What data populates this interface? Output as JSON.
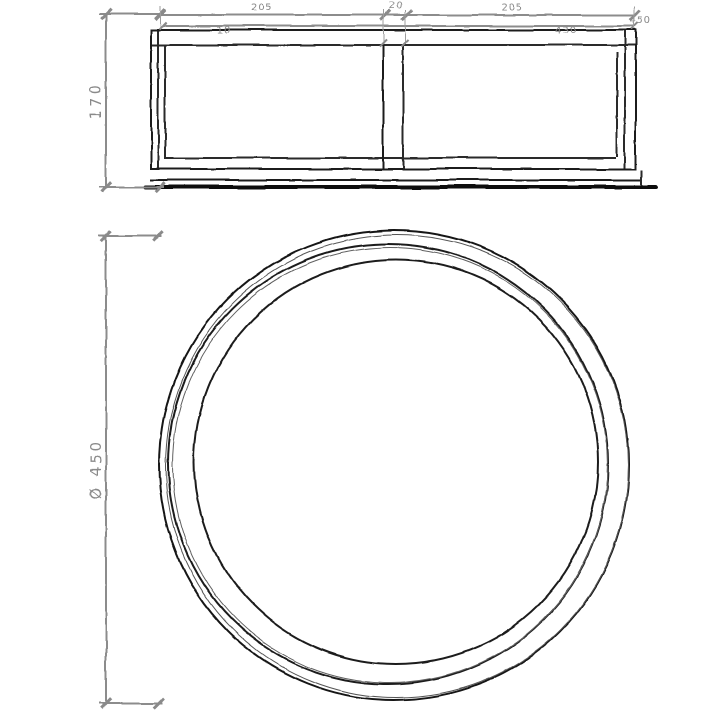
{
  "sheet": {
    "background": "#ffffff"
  },
  "style": {
    "line_color": "#1b1b1b",
    "dimension_color": "#8c8c8c"
  },
  "front_view": {
    "height_label": "170",
    "top_chain": {
      "left": "205",
      "center": "20",
      "right": "205"
    },
    "rim_label": "10",
    "inner_width_label": "430",
    "overall_width_label": "450"
  },
  "top_view": {
    "diameter_label": "Ø 450"
  }
}
